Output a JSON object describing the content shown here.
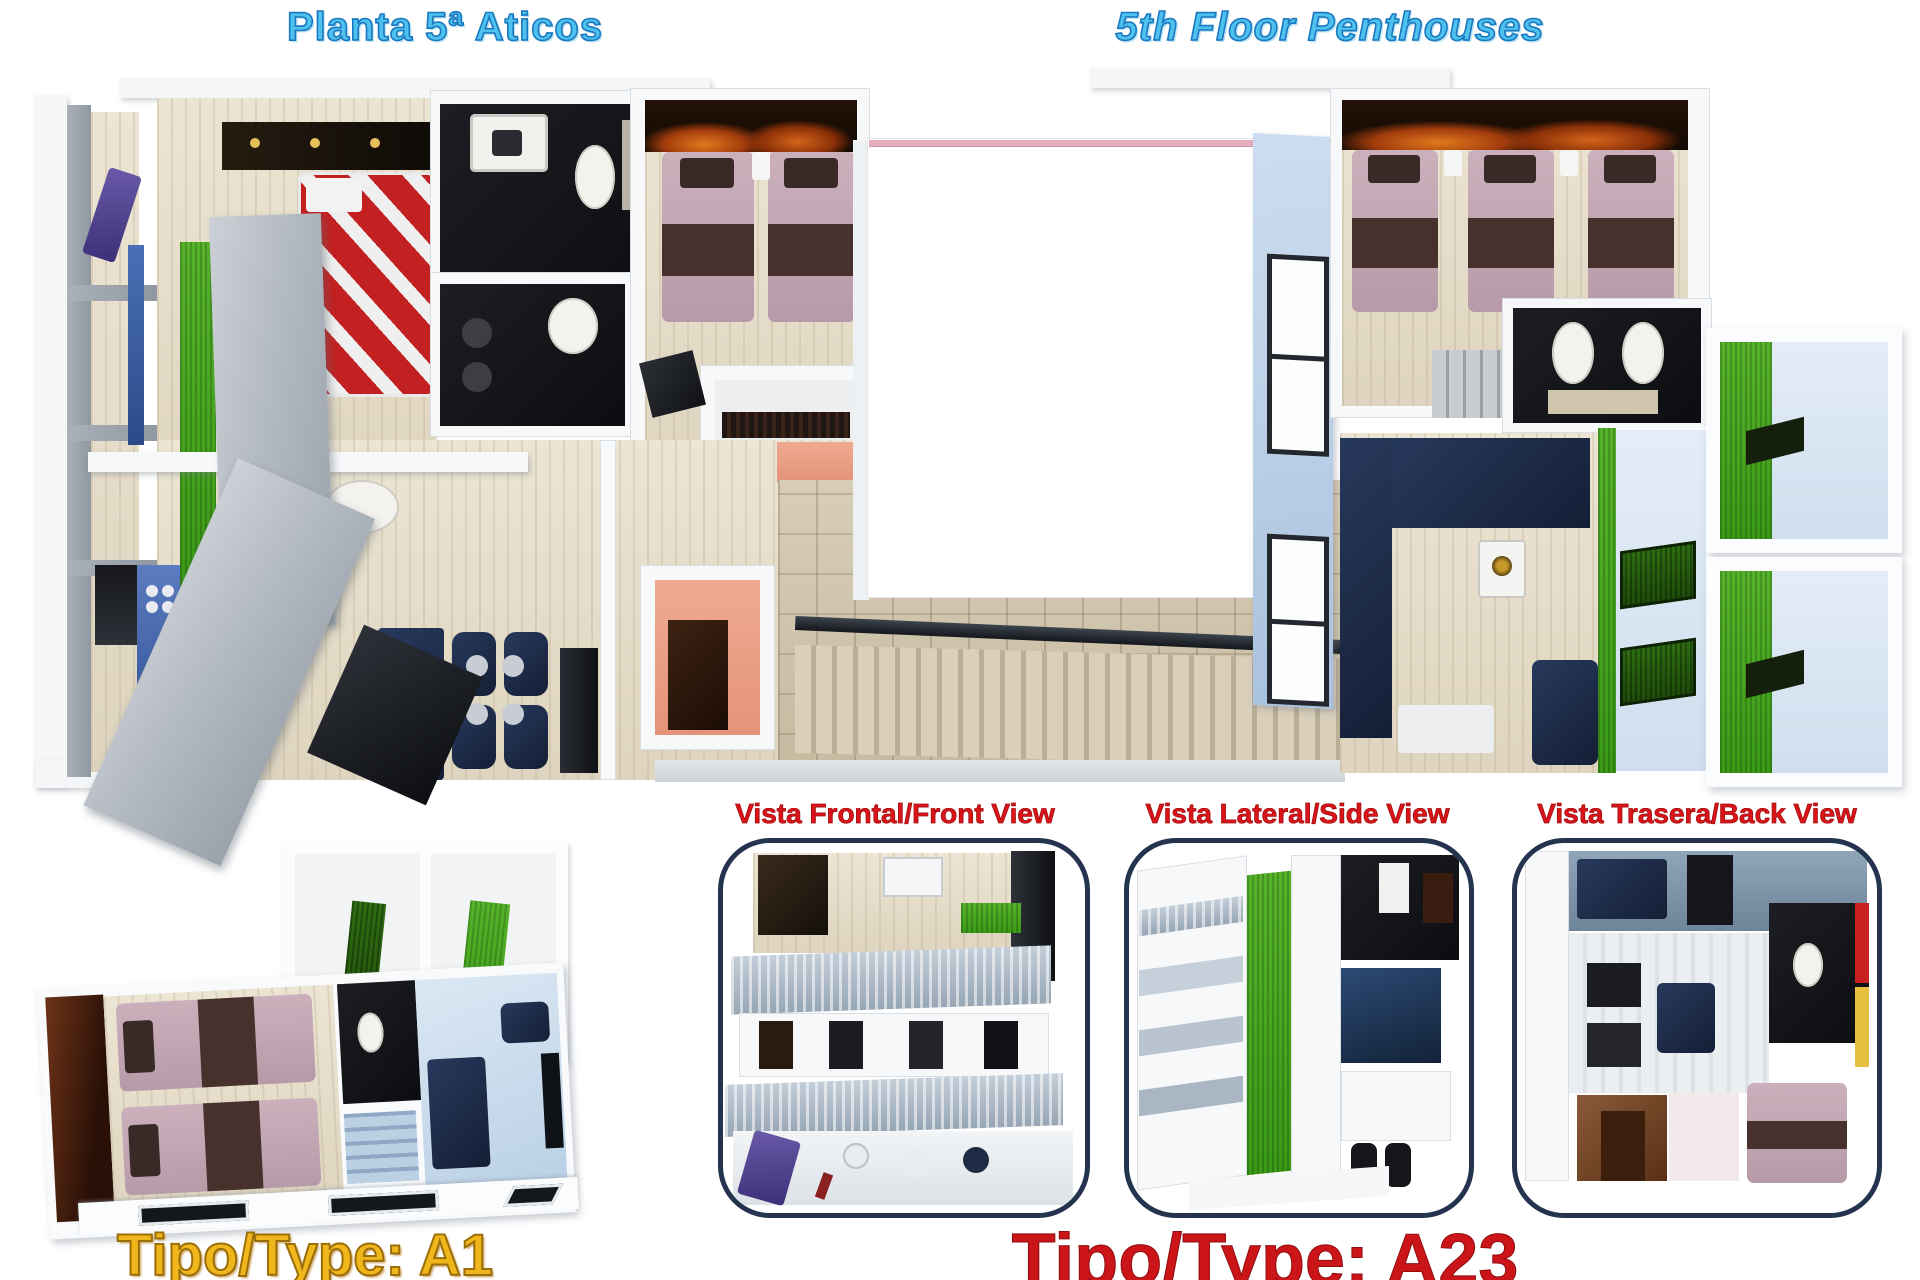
{
  "header": {
    "title_left": "Planta 5ª Aticos",
    "title_right": "5th Floor Penthouses"
  },
  "view_labels": {
    "front": "Vista Frontal/Front View",
    "side": "Vista Lateral/Side View",
    "back": "Vista Trasera/Back View"
  },
  "type_labels": {
    "a1": "Tipo/Type: A1",
    "a23": "Tipo/Type: A23"
  },
  "colors": {
    "title_blue": "#4fc1ef",
    "title_blue_outline": "#1a78bf",
    "view_label_red": "#d9151a",
    "type_gold": "#f0b71d",
    "type_red": "#cc1518",
    "panel_border_navy": "#24334e",
    "courtyard_pink_line": "#e9aebc",
    "grass_green": "#44a31e",
    "bed_mauve": "#c0a3b0",
    "bed_red_white": "#c32121",
    "floor_beige": "#e6dfcd",
    "stair_tan": "#cdc2ab",
    "bathroom_dark": "#16171b",
    "furniture_navy": "#1d2b45",
    "concrete_gray": "#aab0b7",
    "wall_light_blue": "#b9cfe6"
  }
}
